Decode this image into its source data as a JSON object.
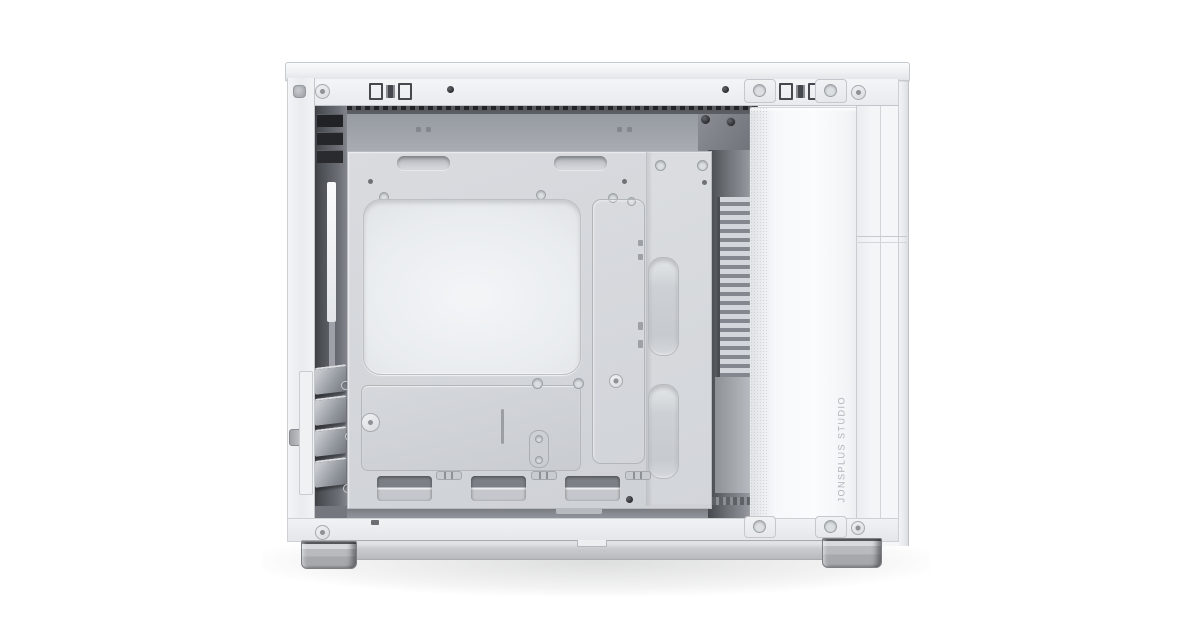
{
  "photo": {
    "subject": "White mini-ITX PC tower case shown from the side with the side panel removed, exposing the motherboard tray and internal chambers",
    "brand_text": "JONSPLUS STUDIO"
  },
  "palette": {
    "background": "#ffffff",
    "outer_frame": "#f2f4f6",
    "motherboard_tray": "#d3d6da",
    "cpu_cutout": "#eef0f3",
    "interior_shadow": "#56595e",
    "front_column": "#f8f9fb",
    "louver_light": "#d2d5d9",
    "brand_text_color": "#aeb3b9",
    "feet": "#a9abaf"
  }
}
